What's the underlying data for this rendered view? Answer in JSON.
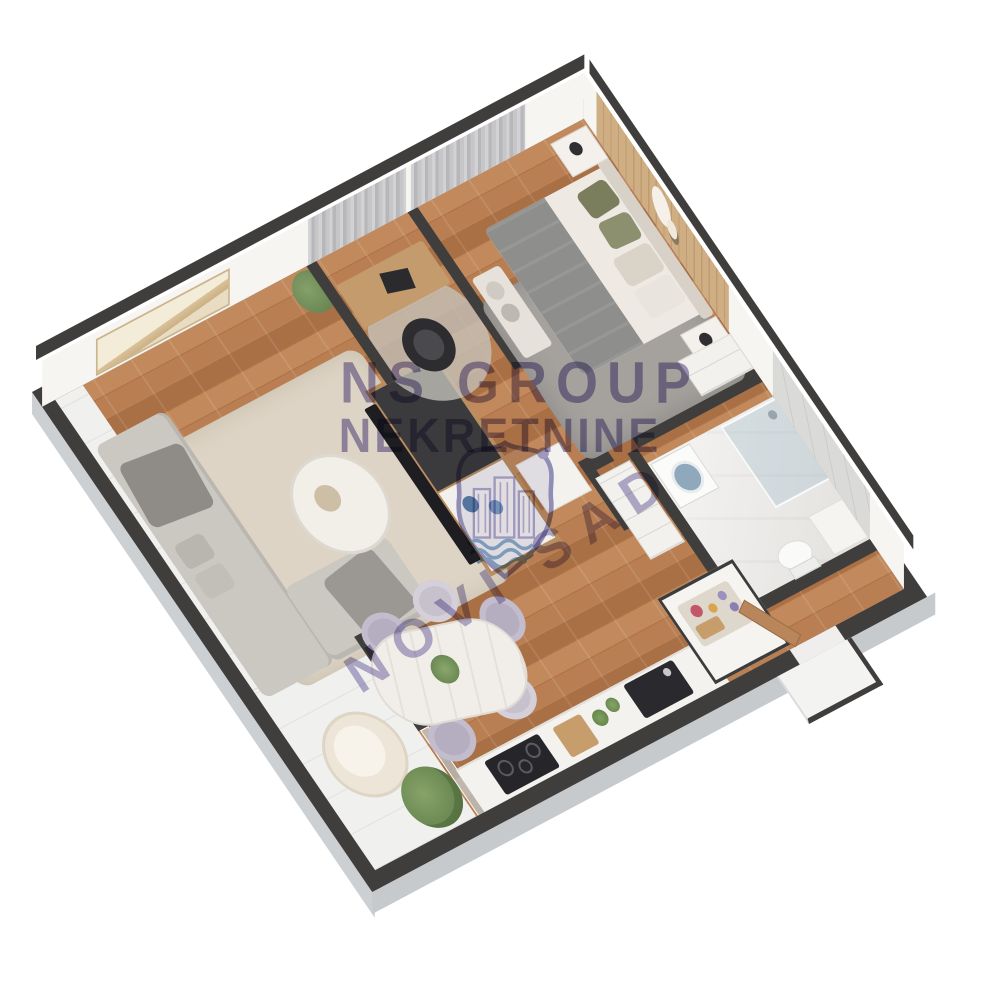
{
  "title": "3D apartment floor plan render",
  "watermark": {
    "line1": "NS GROUP",
    "line2": "NEKRETNINE",
    "diagonal_text": "NOVI SAD",
    "logo_icon": "city-crest-shield-icon",
    "color": "#7266a7"
  },
  "palette": {
    "background": "#ffffff",
    "wall_top": "#3f3e3c",
    "wall_inner_face": "#f7f5f1",
    "wall_outer_face": "#ccd0d2",
    "wood_floor": "#b57e51",
    "marble_floor": "#eae8e5",
    "terrace_floor": "#f0f1f0",
    "accent_wood": "#c9a678",
    "curtain_gray": "#c6c6c9",
    "rug_living": "#ddd4c5",
    "rug_bedroom": "#a5a29e",
    "sofa_gray": "#cbc8c2",
    "blanket_gray": "#8e8e8c",
    "pillow_olive": "#7b7e5d",
    "shower_glass": "#a8c0cd",
    "tv_black": "#1e1e22",
    "counter_white": "#f4f2ee"
  },
  "rooms": [
    {
      "name": "living-room",
      "furniture": [
        "corner-sofa",
        "throw-blankets",
        "coffee-table",
        "area-rug",
        "tv-media-unit",
        "tv-screen",
        "wall-art",
        "potted-plant",
        "side-cabinet"
      ]
    },
    {
      "name": "office-nook",
      "furniture": [
        "desk",
        "office-chair",
        "laptop",
        "window-curtains",
        "round-rug"
      ]
    },
    {
      "name": "bedroom",
      "furniture": [
        "double-bed",
        "headboard",
        "gray-blanket",
        "olive-pillows",
        "nightstand-top",
        "nightstand-bottom",
        "table-lamps",
        "wardrobe",
        "accent-wall-decor",
        "area-rug",
        "storage-bench-with-towels",
        "window-curtains"
      ]
    },
    {
      "name": "bathroom",
      "furniture": [
        "walk-in-shower",
        "washing-machine",
        "toilet",
        "vanity"
      ]
    },
    {
      "name": "hallway",
      "furniture": [
        "closet",
        "entrance-door",
        "entry-vestibule"
      ]
    },
    {
      "name": "kitchen",
      "furniture": [
        "counter-run",
        "induction-cooktop",
        "sink",
        "cutting-board",
        "herb-plants",
        "kitchen-island",
        "breakfast-tray"
      ]
    },
    {
      "name": "dining-area",
      "furniture": [
        "marble-dining-table",
        "dining-chairs",
        "centerpiece-plant"
      ]
    },
    {
      "name": "terrace",
      "furniture": [
        "lounge-chair",
        "potted-plant",
        "glass-slider",
        "side-balcony-strip"
      ]
    }
  ]
}
